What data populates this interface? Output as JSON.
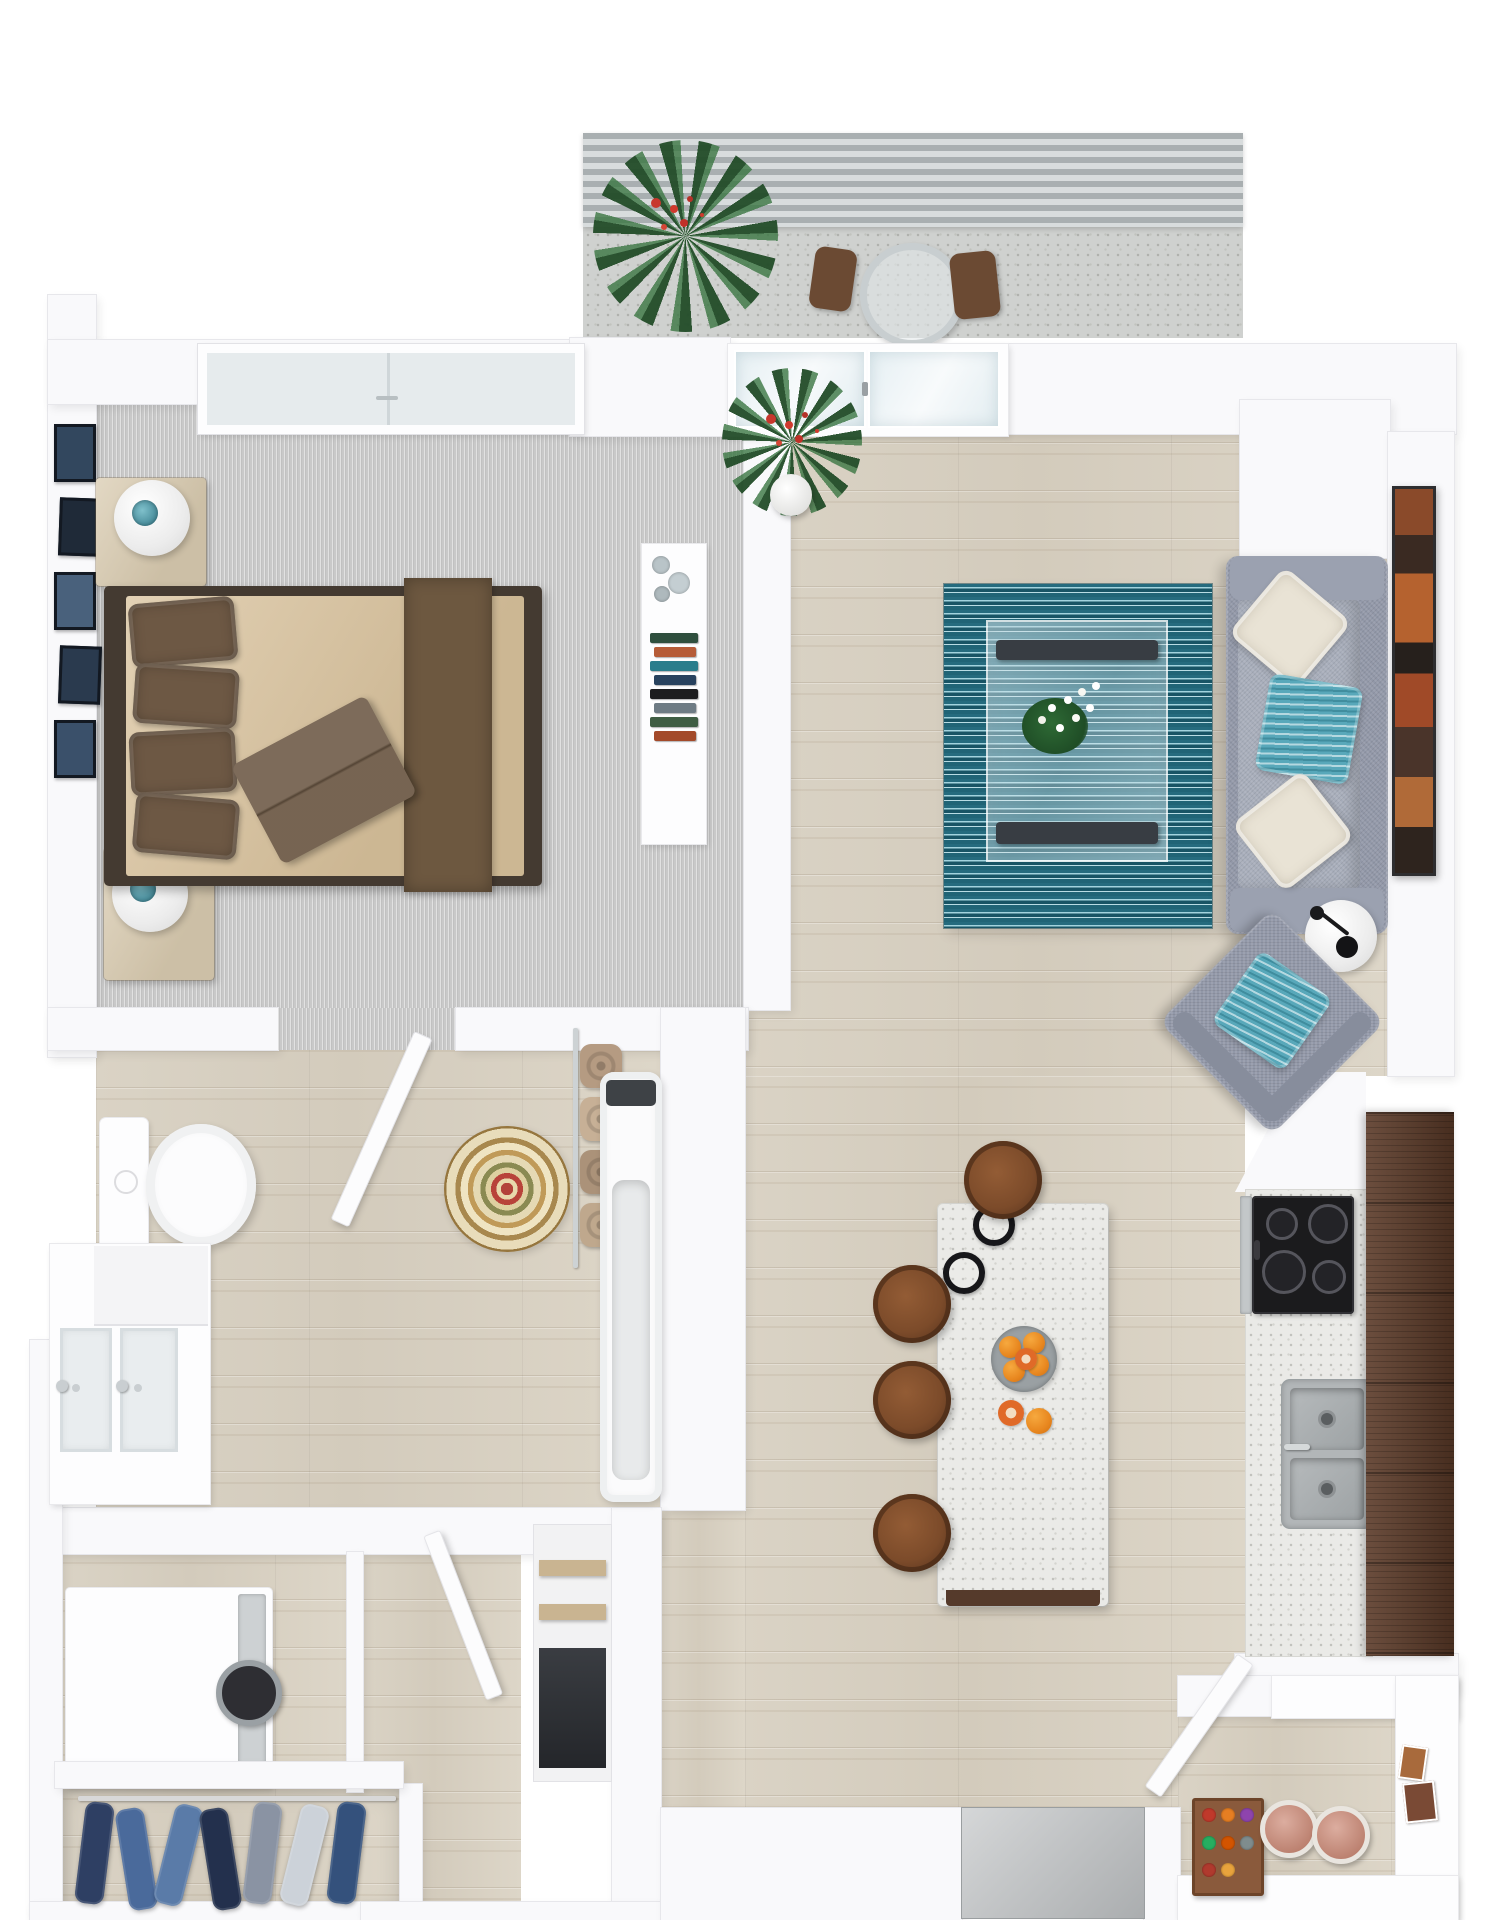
{
  "title": "3D Apartment Floor Plan - Top-Down Render (1 Bed / 1 Bath)",
  "plan": {
    "rooms": {
      "balcony": {
        "label": "Balcony"
      },
      "bedroom": {
        "label": "Bedroom"
      },
      "living": {
        "label": "Living Room"
      },
      "kitchen": {
        "label": "Kitchen"
      },
      "bathroom": {
        "label": "Bathroom"
      },
      "laundry": {
        "label": "Laundry"
      },
      "closet": {
        "label": "Closet"
      },
      "hall": {
        "label": "Hallway"
      },
      "entry": {
        "label": "Entry"
      }
    }
  },
  "palette": {
    "wood_floor": "#d8d1c3",
    "carpet_gray": "#c9c9c9",
    "wall_white": "#f9f9fb",
    "rug_teal": "#256b7e",
    "sofa_gray": "#9298a8",
    "sofa_seat": "#a8aebb",
    "pillow_cream": "#e9e3d5",
    "pillow_teal": "#58a8ba",
    "bed_duvet": "#d9c29c",
    "bed_pillow_brown": "#6d5844",
    "bed_runner": "#6d5840",
    "bed_throw": "#6b5743",
    "bed_frame": "#443a31",
    "nightstand_wood": "#d9cbb0",
    "cabinet_walnut": "#5b3a28",
    "counter_speckle": "#eaeae7",
    "island_base": "#553a2b",
    "stool_brown": "#7c4b2a",
    "cooktop_black": "#1b1b1d",
    "sink_steel": "#b2b6b8",
    "orange_fruit": "#e8871f",
    "artwork_frame": "#2e2e30",
    "tub_white": "#fbfbfc",
    "mat_gray": "#b9bcbe",
    "canister_salmon": "#c9816c",
    "tray_wood": "#8a5a3c",
    "railing_gray": "#aab0b2",
    "plant_green": "#2e5d33",
    "flower_red": "#c8372d",
    "balcony_floor": "#cfd1cf",
    "ladder_chrome": "#cdd2d4"
  },
  "builds": {
    "frames": [
      "#32475e",
      "#1f2a38",
      "#49617c",
      "#2a3a4e",
      "#3a506a"
    ],
    "console_books": [
      "#2f4f3e",
      "#b65c38",
      "#2a7d8c",
      "#28425e",
      "#1d1d1f",
      "#6e7b84",
      "#3f5d43",
      "#a34a2a"
    ],
    "towel_rolls": [
      "#b59b82",
      "#c7b096",
      "#ab9279",
      "#bfa88d"
    ],
    "closet_clothes": [
      "#2e3f63",
      "#4a6a9b",
      "#5a7ba8",
      "#23304d",
      "#8a93a3",
      "#ccd2d9",
      "#34517c"
    ],
    "tray_dots": [
      "#c0392b",
      "#e67e22",
      "#8e44ad",
      "#27ae60",
      "#d35400",
      "#7f8c8d",
      "#b03a2e",
      "#e8a33d"
    ]
  }
}
